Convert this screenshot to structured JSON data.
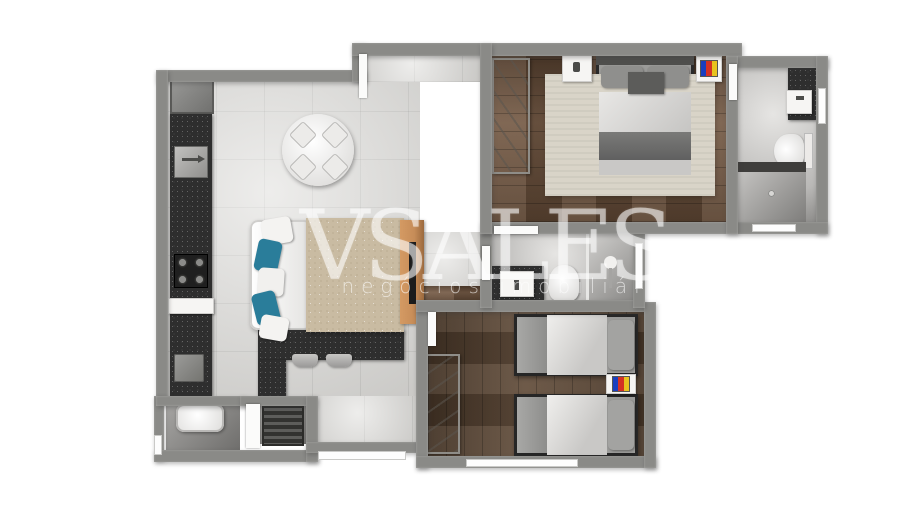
{
  "watermark": {
    "brand": "VSALES",
    "tagline": "negócios imobiliários"
  },
  "colors": {
    "wall": "#8a8a87",
    "tile": "#dcdbd8",
    "wood": "#6e523c",
    "wood2": "#5d4734",
    "counter": "#2e2e2e",
    "rug": "#c9bba2",
    "teal": "#2a7d9a",
    "woodRack": "#c68c58",
    "tvBlue": "#1a3fbf",
    "tvRed": "#d43224",
    "tvYellow": "#e8c31f"
  },
  "rooms": [
    {
      "name": "kitchen",
      "items": [
        "fridge",
        "sink",
        "cooktop",
        "counter",
        "breakfast-bar",
        "stool",
        "stool",
        "washer"
      ]
    },
    {
      "name": "living-dining",
      "items": [
        "round-table",
        "chair",
        "chair",
        "chair",
        "chair",
        "sofa",
        "teal-pillows",
        "rug",
        "tv-rack",
        "tv"
      ]
    },
    {
      "name": "bedroom-1",
      "items": [
        "wardrobe",
        "double-bed",
        "nightstand",
        "rug",
        "tv"
      ]
    },
    {
      "name": "bathroom-1",
      "items": [
        "sink-counter",
        "toilet",
        "shower"
      ]
    },
    {
      "name": "bathroom-2",
      "items": [
        "sink-counter",
        "toilet",
        "shower"
      ]
    },
    {
      "name": "bedroom-2",
      "items": [
        "wardrobe",
        "single-bed",
        "single-bed",
        "tv"
      ]
    },
    {
      "name": "laundry",
      "items": [
        "wash-tub",
        "utility-unit"
      ]
    }
  ]
}
